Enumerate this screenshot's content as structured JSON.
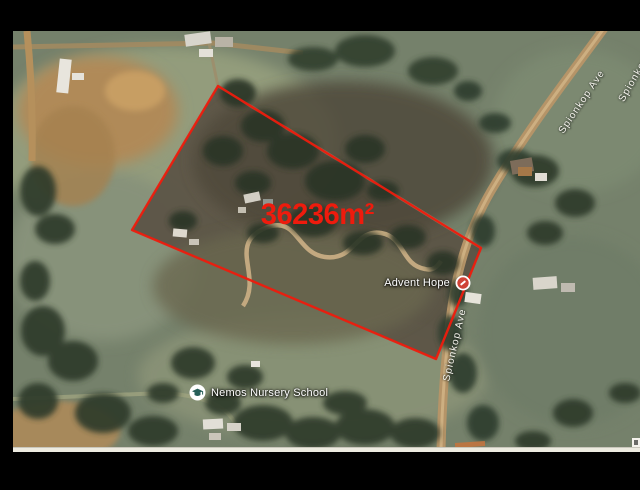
{
  "window": {
    "background": "#000000",
    "kind": "satellite-map-screenshot"
  },
  "map": {
    "imagery": "aerial-satellite",
    "area_label": "36236m²",
    "area_label_color": "#ee1b0d",
    "parcel": {
      "outline_color": "#ee1b0d",
      "polygon_points": "205,55 468,217 423,328 119,199"
    },
    "places": [
      {
        "label": "Advent Hope",
        "icon": "red-place-pin"
      },
      {
        "label": "Nemos Nursery School",
        "icon": "school-graduation-cap-pin"
      }
    ],
    "road_labels": [
      {
        "label": "Spionkop Ave",
        "position": "mid-right-vertical"
      },
      {
        "label": "Spionkop Ave",
        "position": "top-right-diagonal"
      },
      {
        "label": "Spionkop Ave",
        "position": "top-corner-clipped"
      }
    ]
  }
}
